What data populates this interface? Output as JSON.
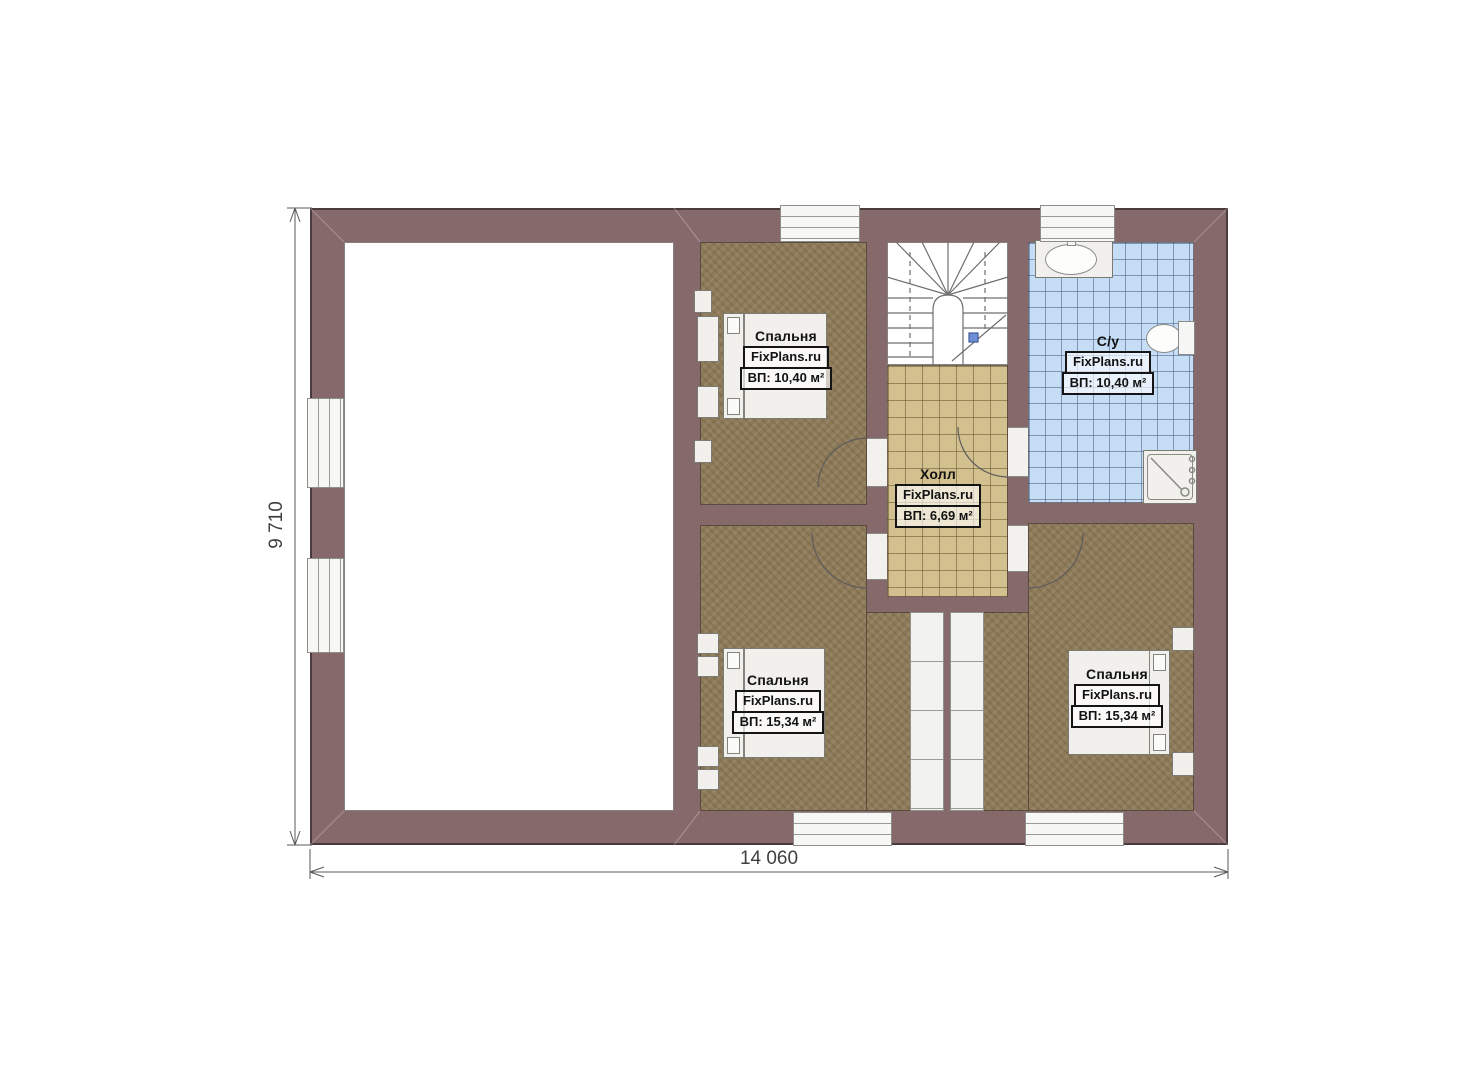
{
  "plan": {
    "type": "floor-plan",
    "watermark": "FixPlans.ru",
    "dimensions": {
      "width_label": "14 060",
      "height_label": "9 710"
    },
    "rooms": [
      {
        "id": "bedroom-top",
        "name": "Спальня",
        "watermark": "FixPlans.ru",
        "area": "ВП: 10,40 м²"
      },
      {
        "id": "bathroom",
        "name": "С/у",
        "watermark": "FixPlans.ru",
        "area": "ВП: 10,40 м²"
      },
      {
        "id": "hall",
        "name": "Холл",
        "watermark": "FixPlans.ru",
        "area": "ВП: 6,69 м²"
      },
      {
        "id": "bedroom-bottom-left",
        "name": "Спальня",
        "watermark": "FixPlans.ru",
        "area": "ВП: 15,34 м²"
      },
      {
        "id": "bedroom-bottom-right",
        "name": "Спальня",
        "watermark": "FixPlans.ru",
        "area": "ВП: 15,34 м²"
      }
    ],
    "colors": {
      "wall": "#86696b",
      "bedroom_floor": "#8d7a58",
      "hall_floor": "#d3c08f",
      "bathroom_floor": "#c5def6",
      "empty_room_floor": "#ffffff",
      "stair_marker_blue": "#6e8fd6"
    }
  }
}
